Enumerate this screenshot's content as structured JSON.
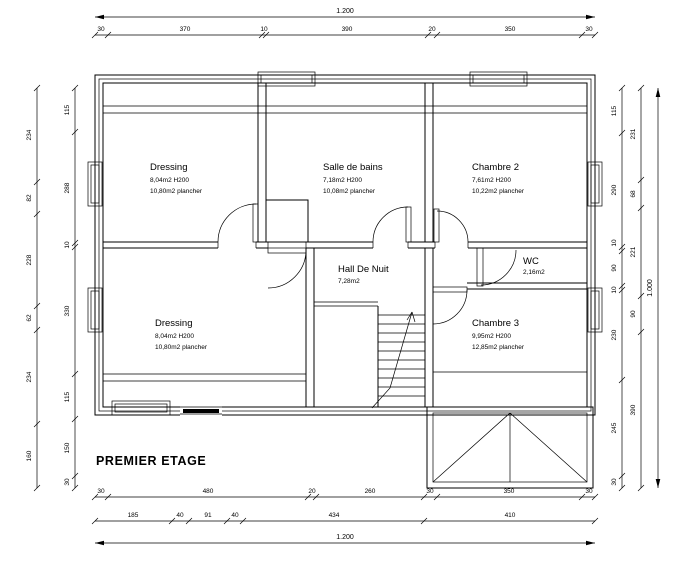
{
  "title": "PREMIER ETAGE",
  "rooms": {
    "dressing_top": {
      "name": "Dressing",
      "area": "8,04m2   H200",
      "floor": "10,80m2  plancher"
    },
    "salle_de_bains": {
      "name": "Salle de bains",
      "area": "7,18m2   H200",
      "floor": "10,08m2  plancher"
    },
    "chambre2": {
      "name": "Chambre 2",
      "area": "7,61m2   H200",
      "floor": "10,22m2  plancher"
    },
    "hall_de_nuit": {
      "name": "Hall De Nuit",
      "area": "7,28m2"
    },
    "wc": {
      "name": "WC",
      "area": "2,16m2"
    },
    "dressing_bottom": {
      "name": "Dressing",
      "area": "8,04m2   H200",
      "floor": "10,80m2  plancher"
    },
    "chambre3": {
      "name": "Chambre 3",
      "area": "9,95m2   H200",
      "floor": "12,85m2  plancher"
    }
  },
  "dimensions": {
    "top_total": "1.200",
    "bottom_total": "1.200",
    "right_total": "1.000",
    "top_chain": [
      "30",
      "370",
      "10",
      "390",
      "20",
      "350",
      "30"
    ],
    "bottom_chain": [
      "30",
      "480",
      "20",
      "260",
      "30",
      "350",
      "30"
    ],
    "bottom_chain2": [
      "185",
      "40",
      "91",
      "40",
      "434",
      "410"
    ],
    "left_outer": [
      "234",
      "82",
      "228",
      "62",
      "234",
      "160"
    ],
    "left_inner": [
      "115",
      "288",
      "10",
      "330",
      "115",
      "150",
      "30"
    ],
    "right_inner": [
      "115",
      "290",
      "10",
      "90",
      "10",
      "230",
      "245",
      "30"
    ],
    "right_middle": [
      "231",
      "68",
      "221",
      "90",
      "390"
    ]
  }
}
